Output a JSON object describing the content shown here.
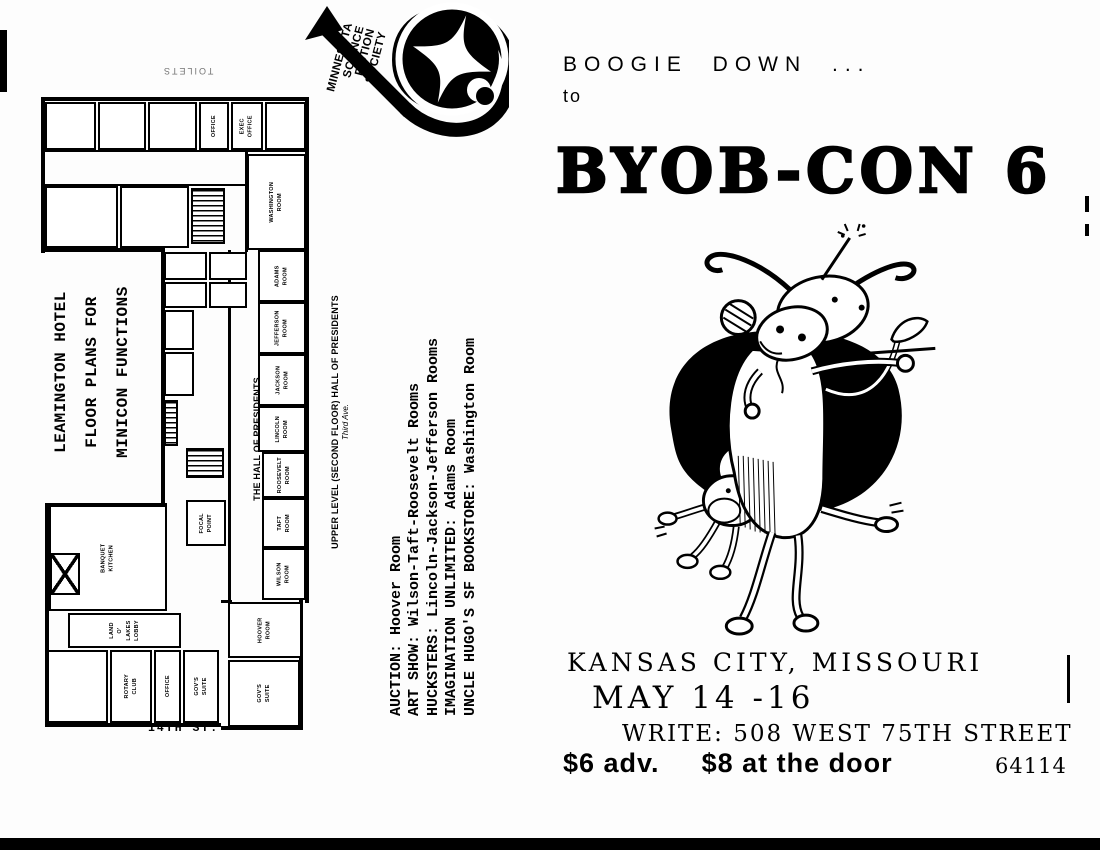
{
  "logo": {
    "org_lines": [
      "MINNESOTA",
      "SCIENCE",
      "FICTION",
      "SOCIETY"
    ],
    "mark": "spiral-arrow-compass-icon"
  },
  "headline": {
    "line1": "BOOGIE DOWN ...",
    "line2": "to",
    "title": "BYOB-CON 6"
  },
  "illustration": {
    "name": "dancing-cows",
    "description": "two cartoon cows boogieing in front of a black blob"
  },
  "details": {
    "location": "KANSAS CITY,  MISSOURI",
    "dates": "MAY 14 -16",
    "write": "WRITE: 508 WEST 75TH STREET",
    "price_adv": "$6 adv.",
    "price_door": "$8 at the door",
    "zip": "64114"
  },
  "floorplan": {
    "headline": [
      "LEAMINGTON HOTEL",
      "FLOOR PLANS FOR",
      "MINICON FUNCTIONS"
    ],
    "functions": [
      "AUCTION: Hoover Room",
      "ART SHOW: Wilson-Taft-Roosevelt Rooms",
      "HUCKSTERS: Lincoln-Jackson-Jefferson Rooms",
      "IMAGINATION UNLIMITED: Adams Room",
      "UNCLE HUGO'S SF BOOKSTORE: Washington Room"
    ],
    "caption": "UPPER LEVEL (SECOND FLOOR) HALL OF PRESIDENTS",
    "caption_sub": "Third Ave.",
    "hall_label": "THE HALL OF PRESIDENTS",
    "street": "14TH ST.",
    "toilets": "TOILETS",
    "rooms": [
      {
        "n": "room-a",
        "x": 45,
        "y": 102,
        "w": 51,
        "h": 48,
        "label": ""
      },
      {
        "n": "room-b",
        "x": 98,
        "y": 102,
        "w": 48,
        "h": 48,
        "label": ""
      },
      {
        "n": "room-c",
        "x": 148,
        "y": 102,
        "w": 49,
        "h": 48,
        "label": ""
      },
      {
        "n": "room-office",
        "x": 199,
        "y": 102,
        "w": 30,
        "h": 48,
        "label": "OFFICE"
      },
      {
        "n": "room-exec-office",
        "x": 231,
        "y": 102,
        "w": 32,
        "h": 48,
        "label": "EXEC\nOFFICE"
      },
      {
        "n": "room-d",
        "x": 265,
        "y": 102,
        "w": 41,
        "h": 48,
        "label": ""
      },
      {
        "n": "room-e",
        "x": 45,
        "y": 186,
        "w": 73,
        "h": 62,
        "label": ""
      },
      {
        "n": "room-f",
        "x": 120,
        "y": 186,
        "w": 69,
        "h": 62,
        "label": ""
      },
      {
        "n": "stairs-north",
        "x": 191,
        "y": 188,
        "w": 34,
        "h": 56,
        "hatch": true,
        "label": ""
      },
      {
        "n": "room-washington",
        "x": 247,
        "y": 154,
        "w": 59,
        "h": 96,
        "label": "WASHINGTON\nROOM"
      },
      {
        "n": "room-adams",
        "x": 258,
        "y": 250,
        "w": 48,
        "h": 52,
        "label": "ADAMS\nROOM"
      },
      {
        "n": "room-jefferson",
        "x": 258,
        "y": 302,
        "w": 48,
        "h": 52,
        "label": "JEFFERSON\nROOM"
      },
      {
        "n": "room-jackson",
        "x": 258,
        "y": 354,
        "w": 48,
        "h": 52,
        "label": "JACKSON\nROOM"
      },
      {
        "n": "room-lincoln",
        "x": 258,
        "y": 406,
        "w": 48,
        "h": 46,
        "label": "LINCOLN\nROOM"
      },
      {
        "n": "room-roosevelt",
        "x": 262,
        "y": 452,
        "w": 44,
        "h": 46,
        "label": "ROOSEVELT\nROOM"
      },
      {
        "n": "room-taft",
        "x": 262,
        "y": 498,
        "w": 44,
        "h": 50,
        "label": "TAFT\nROOM"
      },
      {
        "n": "room-wilson",
        "x": 262,
        "y": 548,
        "w": 44,
        "h": 52,
        "label": "WILSON\nROOM"
      },
      {
        "n": "room-hoover",
        "x": 228,
        "y": 602,
        "w": 74,
        "h": 56,
        "label": "HOOVER\nROOM"
      },
      {
        "n": "room-govs-suite-east",
        "x": 228,
        "y": 660,
        "w": 72,
        "h": 67,
        "label": "GOV'S\nSUITE"
      },
      {
        "n": "room-banquet-kitchen",
        "x": 49,
        "y": 505,
        "w": 118,
        "h": 106,
        "label": "BANQUET\nKITCHEN"
      },
      {
        "n": "elevator",
        "x": 50,
        "y": 553,
        "w": 30,
        "h": 42,
        "elev": true,
        "label": ""
      },
      {
        "n": "room-land-o-lakes-lobby",
        "x": 68,
        "y": 613,
        "w": 113,
        "h": 35,
        "label": "LAND\nO'\nLAKES\nLOBBY"
      },
      {
        "n": "room-g",
        "x": 47,
        "y": 650,
        "w": 61,
        "h": 73,
        "label": ""
      },
      {
        "n": "room-rotary-club",
        "x": 110,
        "y": 650,
        "w": 42,
        "h": 73,
        "label": "ROTARY\nCLUB"
      },
      {
        "n": "room-office-2",
        "x": 154,
        "y": 650,
        "w": 27,
        "h": 73,
        "label": "OFFICE"
      },
      {
        "n": "room-govs-suite-west",
        "x": 183,
        "y": 650,
        "w": 36,
        "h": 73,
        "label": "GOV'S\nSUITE"
      },
      {
        "n": "room-focal-point",
        "x": 186,
        "y": 500,
        "w": 40,
        "h": 46,
        "label": "FOCAL\nPOINT"
      },
      {
        "n": "room-h",
        "x": 164,
        "y": 252,
        "w": 43,
        "h": 28,
        "label": ""
      },
      {
        "n": "room-i",
        "x": 209,
        "y": 252,
        "w": 38,
        "h": 28,
        "label": ""
      },
      {
        "n": "room-j",
        "x": 164,
        "y": 282,
        "w": 43,
        "h": 26,
        "label": ""
      },
      {
        "n": "room-k",
        "x": 209,
        "y": 282,
        "w": 38,
        "h": 26,
        "label": ""
      },
      {
        "n": "room-l",
        "x": 164,
        "y": 310,
        "w": 30,
        "h": 40,
        "label": ""
      },
      {
        "n": "room-m",
        "x": 164,
        "y": 352,
        "w": 30,
        "h": 44,
        "label": ""
      },
      {
        "n": "elevator-2",
        "x": 164,
        "y": 400,
        "w": 14,
        "h": 46,
        "hatch": true,
        "label": ""
      },
      {
        "n": "stairs-south",
        "x": 186,
        "y": 448,
        "w": 38,
        "h": 30,
        "hatch": true,
        "label": ""
      }
    ],
    "walls": [
      {
        "x": 41,
        "y": 97,
        "w": 268,
        "h": 4
      },
      {
        "x": 305,
        "y": 97,
        "w": 4,
        "h": 506
      },
      {
        "x": 41,
        "y": 97,
        "w": 4,
        "h": 156
      },
      {
        "x": 41,
        "y": 248,
        "w": 124,
        "h": 4
      },
      {
        "x": 161,
        "y": 248,
        "w": 4,
        "h": 258
      },
      {
        "x": 228,
        "y": 250,
        "w": 3,
        "h": 352
      },
      {
        "x": 245,
        "y": 152,
        "w": 3,
        "h": 100
      },
      {
        "x": 44,
        "y": 150,
        "w": 262,
        "h": 2
      },
      {
        "x": 44,
        "y": 184,
        "w": 262,
        "h": 2
      },
      {
        "x": 45,
        "y": 503,
        "w": 122,
        "h": 4
      },
      {
        "x": 45,
        "y": 503,
        "w": 4,
        "h": 224
      },
      {
        "x": 45,
        "y": 723,
        "w": 176,
        "h": 4
      },
      {
        "x": 221,
        "y": 726,
        "w": 82,
        "h": 4
      },
      {
        "x": 299,
        "y": 600,
        "w": 4,
        "h": 130
      },
      {
        "x": 221,
        "y": 600,
        "w": 11,
        "h": 3
      }
    ]
  },
  "scan_artifacts": [
    {
      "x": 0,
      "y": 838,
      "w": 1100,
      "h": 12
    },
    {
      "x": 0,
      "y": 30,
      "w": 7,
      "h": 62
    },
    {
      "x": 1085,
      "y": 196,
      "w": 4,
      "h": 16
    },
    {
      "x": 1085,
      "y": 224,
      "w": 4,
      "h": 12
    },
    {
      "x": 1067,
      "y": 655,
      "w": 3,
      "h": 48
    }
  ]
}
